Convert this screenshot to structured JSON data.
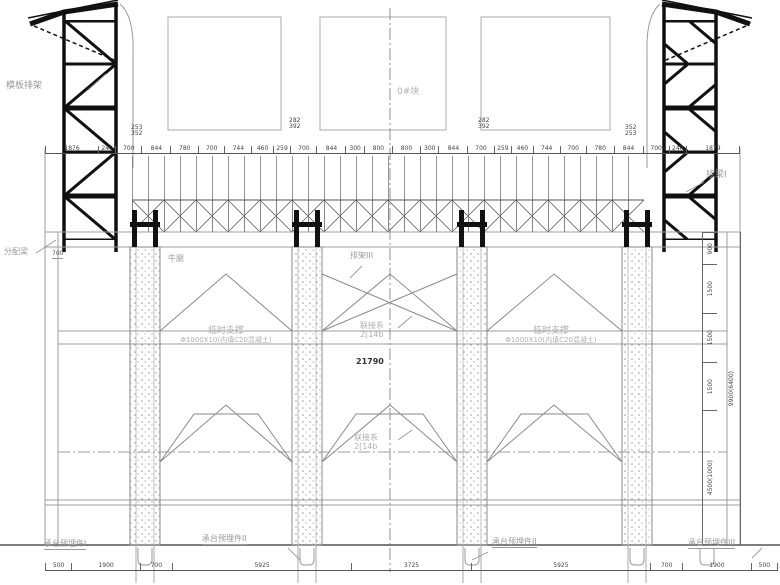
{
  "labels": {
    "left_tower": "模板排架",
    "right_hanging_beam": "挂梁I",
    "segment_block": "0#块",
    "distribution_beam": "分配梁",
    "corbel": "牛腿",
    "corbel_dim": "700",
    "frame_iii": "排架III",
    "temp_support_title": "临时支撑",
    "temp_support_spec": "Φ1000X10(内填C20混凝土)",
    "bracing_title": "联接系",
    "bracing_spec": "2[14b",
    "center_width": "21790",
    "embed_plate_1": "承台预埋件I",
    "embed_plate_2": "承台预埋件II",
    "embed_plate_2b": "承台预埋件II",
    "embed_plate_3": "承台预埋件III"
  },
  "dimensions": {
    "top_chain": [
      "1876",
      "240",
      "700",
      "844",
      "780",
      "700",
      "744",
      "460",
      "259",
      "700",
      "844",
      "300",
      "800",
      "800",
      "300",
      "844",
      "700",
      "259",
      "460",
      "744",
      "700",
      "780",
      "844",
      "700",
      "240",
      "1879"
    ],
    "top_stacked": {
      "p1": [
        "253",
        "352"
      ],
      "p2": [
        "282",
        "392"
      ],
      "p3": [
        "282",
        "392"
      ],
      "p4": [
        "352",
        "253"
      ]
    },
    "right_chain": [
      "900",
      "1500",
      "1500",
      "1500",
      "4500(1000)"
    ],
    "right_total": "9900(6400)",
    "bottom_chain": [
      "500",
      "1900",
      "700",
      "5925",
      "3725",
      "5925",
      "700",
      "1900",
      "500"
    ]
  }
}
